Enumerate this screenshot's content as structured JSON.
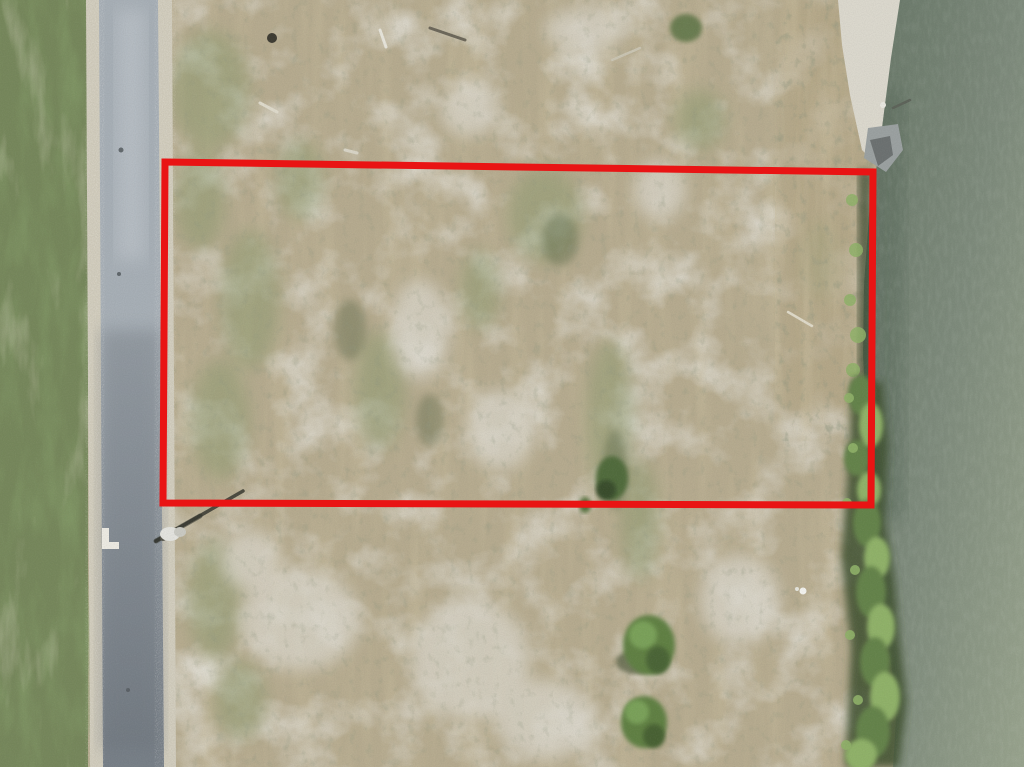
{
  "meta": {
    "description": "Aerial drone photograph of a cleared vacant land parcel outlined with a red property-boundary rectangle, bordered by a paved road with grass verge on the left and a gray-green lake shoreline with brush and trees on the right.",
    "image_width": 1024,
    "image_height": 767
  },
  "scene": {
    "boundary": {
      "label": "property-boundary",
      "points": "165,162 873,172 871,505 163,503",
      "stroke_color": "#e91414",
      "stroke_width": 7
    },
    "colors": {
      "lot_base": "#b5aa8e",
      "lot_green": "#87976a",
      "sand_white": "#dbd8cd",
      "grass_green": "#75865a",
      "shoulder": "#cfcaba",
      "road_light": "#a6aeb5",
      "road_dark": "#767e86",
      "marking_white": "#eceae2",
      "water_dark": "#667566",
      "water_mid": "#7c897a",
      "water_light": "#97a28c",
      "veg_green": "#63824a",
      "veg_green_light": "#8fb168",
      "veg_dark": "#3e4f2d",
      "brush_tan": "#b2a483",
      "boundary_red": "#e91414"
    },
    "features": [
      {
        "name": "property-boundary-outline",
        "note": "red rectangle overlay marking the lot"
      },
      {
        "name": "vacant-lot-ground",
        "note": "mottled sandy soil with dried grass streaks and scrub patches"
      },
      {
        "name": "paved-road",
        "note": "gray asphalt road running vertically on the left with gravel shoulders"
      },
      {
        "name": "grass-verge",
        "note": "green grass strip along the far left edge"
      },
      {
        "name": "road-marking-L",
        "note": "white L-shaped pavement marking"
      },
      {
        "name": "utility-pole",
        "note": "pole beside the road casting a thin diagonal shadow"
      },
      {
        "name": "sand-bank",
        "note": "white sandy bank at the top-right shoreline"
      },
      {
        "name": "dock-remnant",
        "note": "gray debris at the water edge near the top-right boundary corner"
      },
      {
        "name": "water-body",
        "note": "gray-green lake occupying the right edge"
      },
      {
        "name": "shoreline-brush",
        "note": "tan dry brush band along the upper shoreline"
      },
      {
        "name": "shoreline-vegetation",
        "note": "green shrub and tree band along the lower shoreline"
      },
      {
        "name": "bush-cluster",
        "note": "green bushes near the bottom center of the lot"
      },
      {
        "name": "debris-sticks",
        "note": "scattered light sticks and dark debris near the top of the lot"
      },
      {
        "name": "bird",
        "note": "small white speck near the lower-right vegetation"
      }
    ]
  }
}
